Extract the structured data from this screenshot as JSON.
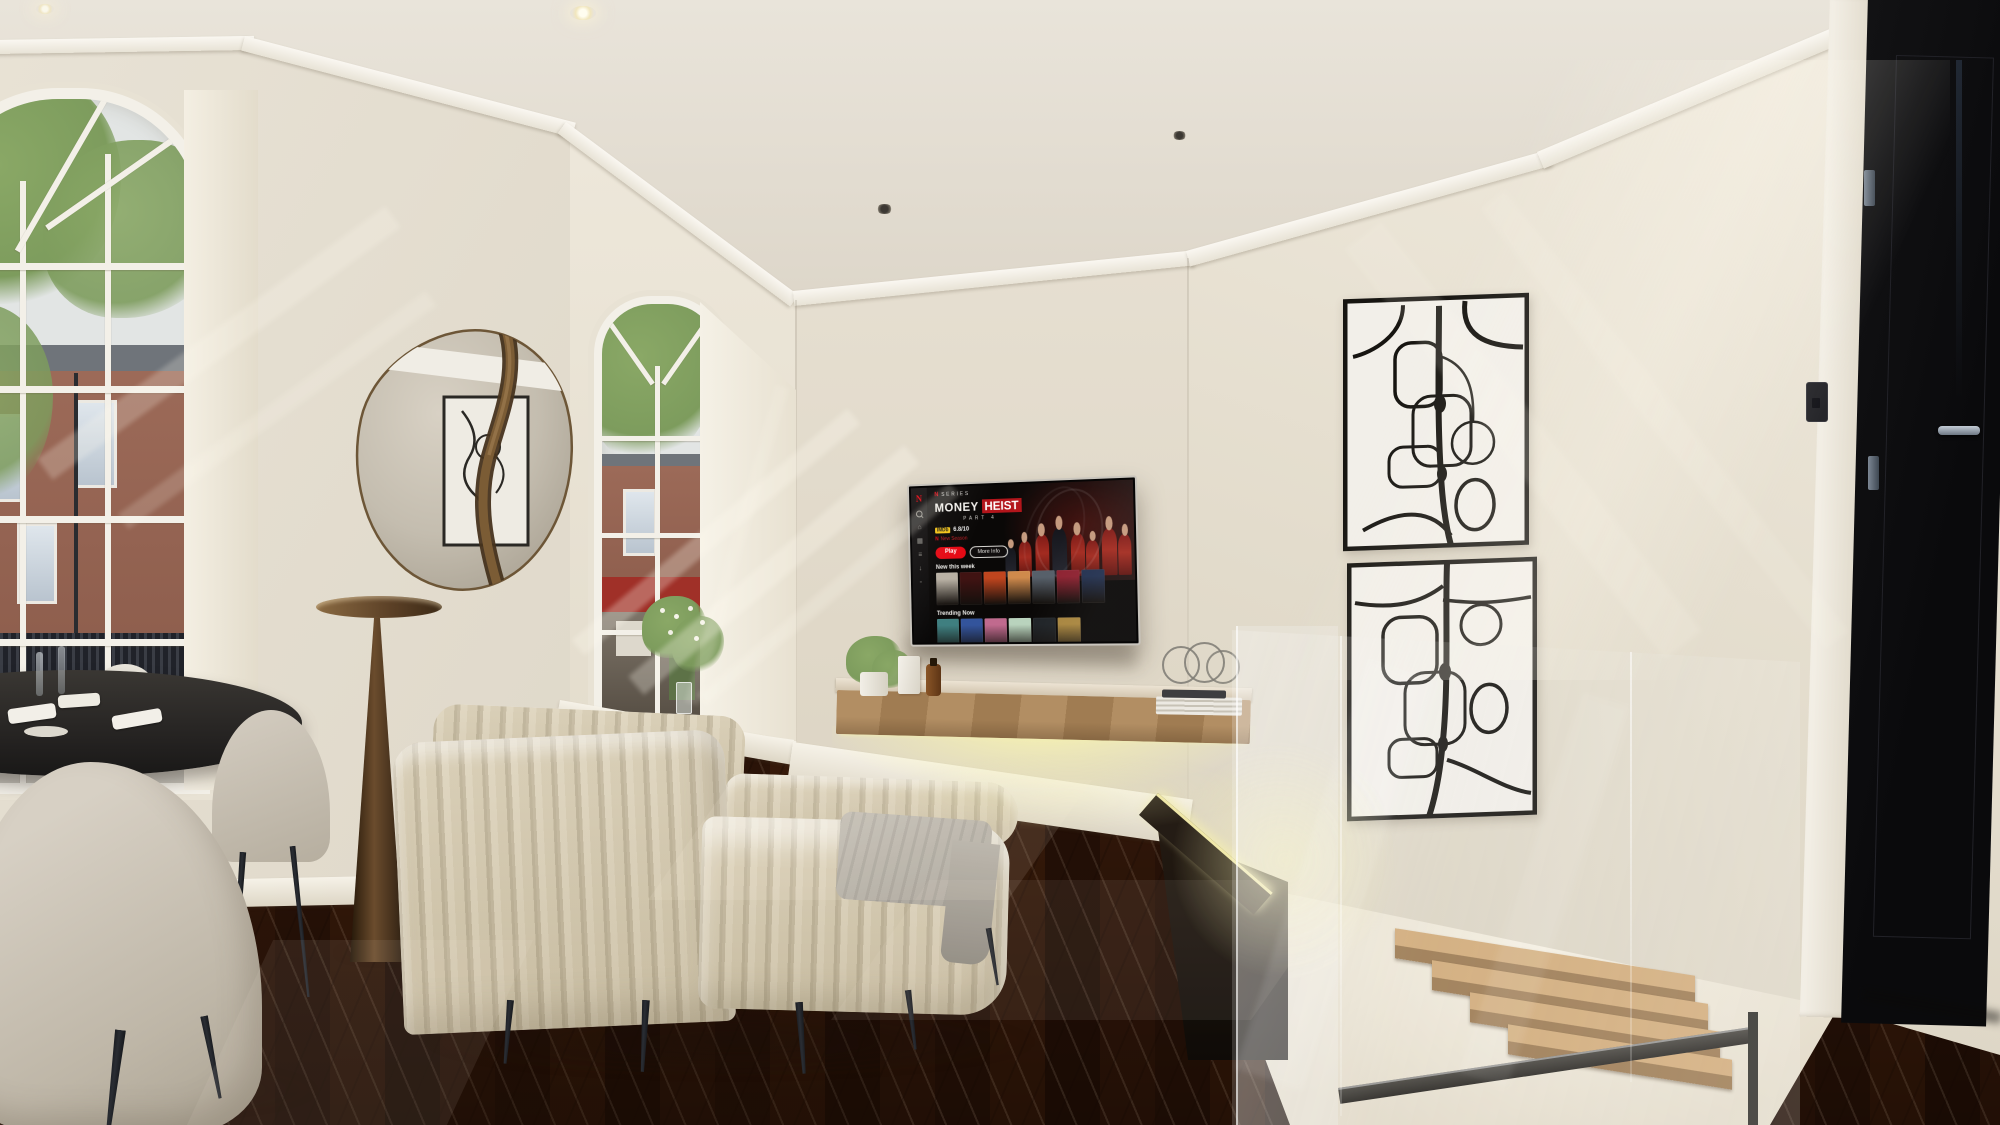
{
  "scene": {
    "setting": "Sunlit modern living room with herringbone parquet floor, arched sash windows, wall-mounted TV, floating media console, glass balustrade stairwell and black entry door",
    "room_features": [
      "arched window",
      "round organic mirror with bronze band",
      "bronze cone floor lamp",
      "cream channel-tufted chaise sofa",
      "wall-mounted tv",
      "floating wood media console with led underglow",
      "abstract black line artworks",
      "glass balustrade over staircase",
      "black panelled door",
      "dark round dining table with grey tub chairs",
      "herringbone parquet floor",
      "recessed ceiling spotlights"
    ],
    "window_count": 2,
    "artwork_count": 2,
    "spotlight_count": 4,
    "colors": {
      "wall": "#e7e1d5",
      "wall_shade": "#d8d1c2",
      "ceiling": "#e6e0d4",
      "molding": "#f6f3ec",
      "floor": "#67452c",
      "floor_light": "#7b5538",
      "floor_dark": "#4e3420",
      "led_glow": "#f2edb0",
      "sofa": "#e9e4d8",
      "lamp_bronze": "#6e4f2f",
      "door": "#0e0e10",
      "stair_wood": "#c89f6e",
      "chair": "#c7c0b4",
      "table": "#2b2a28",
      "marble": "#20261f",
      "netflix_red": "#e50914",
      "imdb_yellow": "#f5c518",
      "art_line": "#1a1816",
      "art_bg": "#f2efe9",
      "brick": "#9c6a58",
      "foliage": "#7d9c5d",
      "sky": "#e2e5e4",
      "railing": "#23252b",
      "glass_edge": "#ffffff"
    }
  },
  "tv": {
    "provider_logo": "N",
    "badge": "SERIES",
    "title_word1": "MONEY",
    "title_word2": "HEIST",
    "subtitle": "PART 4",
    "rating_source": "IMDb",
    "rating_value": "6.8/10",
    "season_note": "New Season",
    "play_label": "Play",
    "info_label": "More Info",
    "sidebar_icons": [
      "search-icon",
      "home-icon",
      "grid-icon",
      "list-icon",
      "download-icon",
      "profile-icon"
    ],
    "sidebar_glyphs": [
      "⌂",
      "▦",
      "≡",
      "↓",
      "◦"
    ],
    "rows": [
      {
        "heading": "New this week",
        "poster_colors": [
          "#b9b1a4",
          "#401312",
          "#c0451e",
          "#cf8a4c",
          "#57606a",
          "#8e2332",
          "#233150"
        ]
      },
      {
        "heading": "Trending Now",
        "poster_colors": [
          "#3f7f80",
          "#33549c",
          "#c06a8e",
          "#b9d3bd",
          "#1f2327",
          "#a8853e"
        ]
      }
    ]
  }
}
